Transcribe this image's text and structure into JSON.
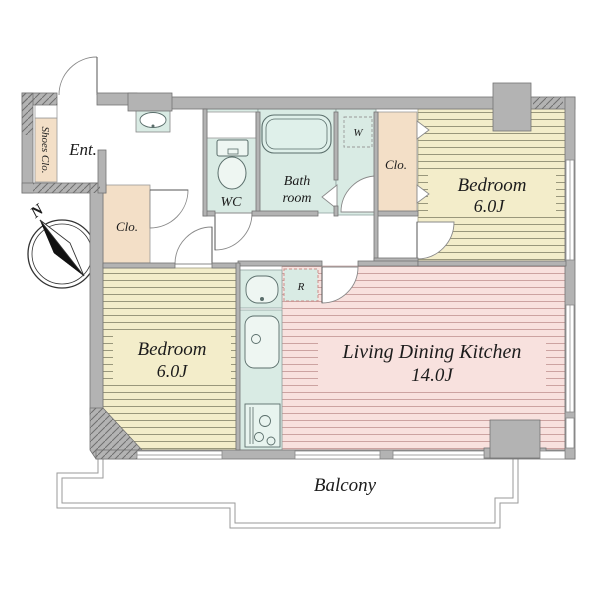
{
  "floorplan": {
    "compass": {
      "north_label": "N"
    },
    "labels": {
      "entrance": "Ent.",
      "shoes_closet": "Shoes Clo.",
      "wc": "WC",
      "bathroom_line1": "Bath",
      "bathroom_line2": "room",
      "washer_space": "W",
      "closet_upper": "Clo.",
      "closet_lower": "Clo.",
      "bedroom_upper_name": "Bedroom",
      "bedroom_upper_area": "6.0J",
      "bedroom_lower_name": "Bedroom",
      "bedroom_lower_area": "6.0J",
      "ldk_name": "Living Dining Kitchen",
      "ldk_area": "14.0J",
      "refrigerator_space": "R",
      "balcony": "Balcony"
    },
    "icons": [
      "compass-icon",
      "entrance-door-swing-icon",
      "toilet-icon",
      "bathtub-icon",
      "washbasin-icon",
      "vanity-basin-icon",
      "kitchen-sink-icon",
      "stove-icon",
      "washing-machine-space-icon",
      "refrigerator-space-icon",
      "door-swing-icon",
      "folding-door-icon",
      "window-icon"
    ],
    "colors": {
      "wall_gray": "#b3b3b3",
      "tatami_yellow": "#f3edca",
      "tatami_stripe": "#8f8d72",
      "ldk_pink": "#f8e1de",
      "ldk_stripe": "#c79c9a",
      "wet_area_teal": "#d9ebe4",
      "closet_beige": "#f3dfc7",
      "line_dark": "#555555",
      "refrigerator_dash": "#cc8f8b"
    }
  }
}
